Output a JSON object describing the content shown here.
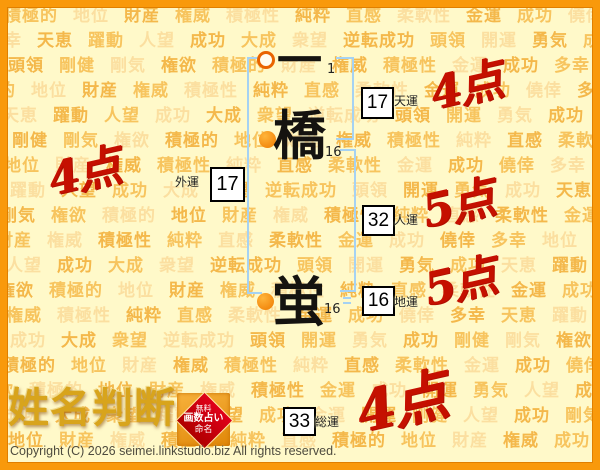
{
  "page": {
    "logo_text": "姓名判断",
    "copyright": "Copyright (C) 2026 seimei.linkstudio.biz All rights reserved.",
    "stamp": {
      "line1": "無料",
      "line2": "画数占い",
      "line3": "命名"
    },
    "colors": {
      "frame_orange": "#F9990B",
      "background": "#FFF9C9",
      "bracket_blue": "#A5D2F3",
      "score_red": "#C51000",
      "circle_orange": "#EE7A00",
      "logo_gold": "#D8A41C"
    }
  },
  "name_chart": {
    "characters": [
      {
        "char": "一",
        "strokes": "1"
      },
      {
        "char": "橋",
        "strokes": "16"
      },
      {
        "char": "蛍",
        "strokes": "16"
      }
    ],
    "fortunes": {
      "tenun": {
        "value": "17",
        "label": "天運",
        "score": "4点"
      },
      "jinun": {
        "value": "32",
        "label": "人運",
        "score": "5点"
      },
      "chiun": {
        "value": "16",
        "label": "地運",
        "score": "5点"
      },
      "gaiun": {
        "value": "17",
        "label": "外運",
        "score": "4点"
      },
      "soun": {
        "value": "33",
        "label": "総運",
        "score": "4点"
      }
    }
  },
  "background_words": {
    "rows": [
      {
        "offset": 4,
        "text": "積極的 地位 財産 権威 積極性 純粋 直感 柔軟性 金運 成功 僥倖 多幸"
      },
      {
        "offset": 4,
        "text": "幸 天恵 躍動 人望 成功 大成 衆望 逆転成功 頭領 開運 勇気 成功"
      },
      {
        "offset": 8,
        "text": "頭領 剛健 剛気 権欲 積極的 財産 権威 積極性 金運 成功 多幸 天恵"
      },
      {
        "offset": -2,
        "text": "的 地位 財産 権威 積極性 純粋 直感 柔軟性 金運 成功 僥倖 多幸"
      },
      {
        "offset": 2,
        "text": "天恵 躍動 人望 成功 大成 衆望 逆転成功 頭領 開運 勇気 成功 頭領"
      },
      {
        "offset": 12,
        "text": "剛健 剛気 権欲 積極的 地位 財産 権威 積極性 純粋 直感 柔軟性"
      },
      {
        "offset": 4,
        "text": "地位 財産 権威 積極性 純粋 直感 柔軟性 金運 成功 僥倖 多幸 幸"
      },
      {
        "offset": 10,
        "text": "躍動 人望 成功 大成 衆望 逆転成功 頭領 開運 勇気 成功 天恵 躍動"
      },
      {
        "offset": 0,
        "text": "剛気 権欲 積極的 地位 財産 権威 積極性 純粋 直感 柔軟性 金運 成功"
      },
      {
        "offset": -4,
        "text": "財産 権威 積極性 純粋 直感 柔軟性 金運 成功 僥倖 多幸 地位 財産"
      },
      {
        "offset": 6,
        "text": "人望 成功 大成 衆望 逆転成功 頭領 開運 勇気 成功 天恵 躍動 人望"
      },
      {
        "offset": -2,
        "text": "権欲 積極的 地位 財産 権威 積極性 純粋 直感 柔軟性 金運 成功 僥倖"
      },
      {
        "offset": 6,
        "text": "権威 積極性 純粋 直感 柔軟性 金運 成功 僥倖 多幸 天恵 躍動 頭領"
      },
      {
        "offset": 10,
        "text": "成功 大成 衆望 逆転成功 頭領 開運 勇気 成功 剛健 剛気 権欲 積極的"
      },
      {
        "offset": 2,
        "text": "積極的 地位 財産 権威 積極性 純粋 直感 柔軟性 金運 成功 僥倖 多幸"
      },
      {
        "offset": -4,
        "text": "欲 積極的 地位 財産 権威 積極性 金運 成功 開運 勇気 人望 成功"
      },
      {
        "offset": 4,
        "text": "成功 大成 衆望 躍動 人望 成功 金運 開運 剛健 人望 成功 剛気"
      },
      {
        "offset": 8,
        "text": "地位 財産 権威 積極性 純粋 直感 積極的 地位 財産 権威 成功 多幸"
      }
    ]
  }
}
